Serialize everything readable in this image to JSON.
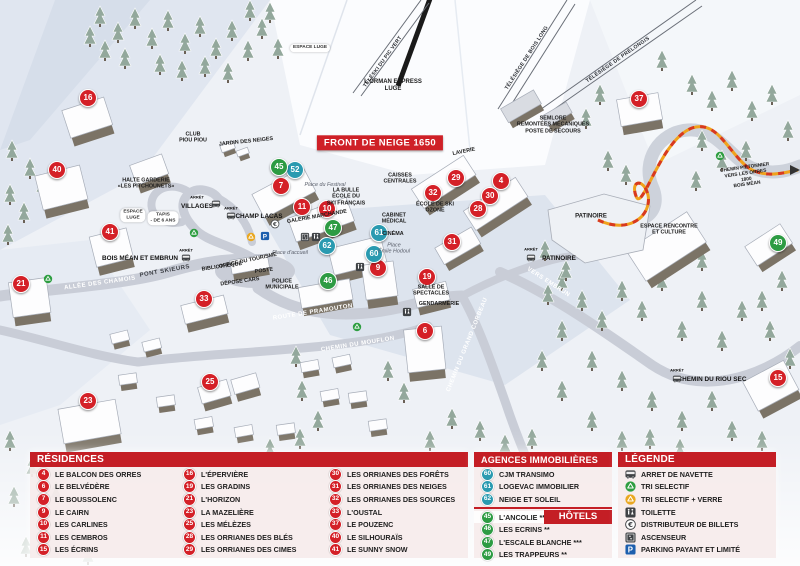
{
  "colors": {
    "header_red": "#c41e25",
    "marker_red": "#d42027",
    "marker_blue": "#2a9ab0",
    "marker_green": "#2d9b43",
    "path_orange": "#f0a21c",
    "path_red_dash": "#d8391f",
    "panel_pink": "#f6ecec"
  },
  "map": {
    "banner": "FRONT DE NEIGE 1650",
    "markers": [
      {
        "n": "16",
        "type": "red",
        "x": 88,
        "y": 98
      },
      {
        "n": "40",
        "type": "red",
        "x": 57,
        "y": 170
      },
      {
        "n": "41",
        "type": "red",
        "x": 110,
        "y": 232
      },
      {
        "n": "21",
        "type": "red",
        "x": 21,
        "y": 284
      },
      {
        "n": "33",
        "type": "red",
        "x": 204,
        "y": 299
      },
      {
        "n": "23",
        "type": "red",
        "x": 88,
        "y": 401
      },
      {
        "n": "25",
        "type": "red",
        "x": 210,
        "y": 382
      },
      {
        "n": "7",
        "type": "red",
        "x": 281,
        "y": 186
      },
      {
        "n": "11",
        "type": "red",
        "x": 302,
        "y": 207
      },
      {
        "n": "10",
        "type": "red",
        "x": 327,
        "y": 209
      },
      {
        "n": "9",
        "type": "red",
        "x": 378,
        "y": 268
      },
      {
        "n": "19",
        "type": "red",
        "x": 427,
        "y": 277
      },
      {
        "n": "6",
        "type": "red",
        "x": 425,
        "y": 331
      },
      {
        "n": "29",
        "type": "red",
        "x": 456,
        "y": 178
      },
      {
        "n": "4",
        "type": "red",
        "x": 501,
        "y": 181
      },
      {
        "n": "32",
        "type": "red",
        "x": 433,
        "y": 193
      },
      {
        "n": "30",
        "type": "red",
        "x": 490,
        "y": 196
      },
      {
        "n": "28",
        "type": "red",
        "x": 478,
        "y": 209
      },
      {
        "n": "31",
        "type": "red",
        "x": 452,
        "y": 242
      },
      {
        "n": "37",
        "type": "red",
        "x": 639,
        "y": 99
      },
      {
        "n": "15",
        "type": "red",
        "x": 778,
        "y": 378
      },
      {
        "n": "52",
        "type": "blue",
        "x": 295,
        "y": 170
      },
      {
        "n": "62",
        "type": "blue",
        "x": 327,
        "y": 246
      },
      {
        "n": "60",
        "type": "blue",
        "x": 374,
        "y": 254
      },
      {
        "n": "61",
        "type": "blue",
        "x": 379,
        "y": 233
      },
      {
        "n": "45",
        "type": "green",
        "x": 279,
        "y": 167
      },
      {
        "n": "47",
        "type": "green",
        "x": 333,
        "y": 228
      },
      {
        "n": "46",
        "type": "green",
        "x": 328,
        "y": 281
      },
      {
        "n": "49",
        "type": "green",
        "x": 778,
        "y": 243
      }
    ],
    "icons": [
      {
        "icon": "bus",
        "x": 216,
        "y": 204
      },
      {
        "icon": "bus",
        "x": 231,
        "y": 216
      },
      {
        "icon": "bus",
        "x": 186,
        "y": 258
      },
      {
        "icon": "bus",
        "x": 531,
        "y": 258
      },
      {
        "icon": "bus",
        "x": 677,
        "y": 379
      },
      {
        "icon": "recycle-green",
        "x": 48,
        "y": 279
      },
      {
        "icon": "recycle-green",
        "x": 194,
        "y": 233
      },
      {
        "icon": "recycle-green",
        "x": 357,
        "y": 327
      },
      {
        "icon": "recycle-green",
        "x": 720,
        "y": 156
      },
      {
        "icon": "recycle-yellow",
        "x": 251,
        "y": 237
      },
      {
        "icon": "parking",
        "x": 265,
        "y": 236
      },
      {
        "icon": "euro",
        "x": 275,
        "y": 224
      },
      {
        "icon": "elevator",
        "x": 305,
        "y": 237
      },
      {
        "icon": "toilet",
        "x": 316,
        "y": 237
      },
      {
        "icon": "toilet",
        "x": 360,
        "y": 267
      },
      {
        "icon": "toilet",
        "x": 407,
        "y": 312
      }
    ],
    "labels": [
      {
        "t": "TÉLÉSKI DU PIC VERT",
        "x": 383,
        "y": 62,
        "c": "lift",
        "r": -54
      },
      {
        "t": "L'ORMAN EXPRESS\nLUGE",
        "x": 393,
        "y": 86,
        "c": "place",
        "r": 0
      },
      {
        "t": "TÉLÉSIÈGE DE BOIS LONG",
        "x": 527,
        "y": 58,
        "c": "lift",
        "r": -57
      },
      {
        "t": "TÉLÉSIÈGE DE PRÉLONGIS",
        "x": 618,
        "y": 60,
        "c": "lift",
        "r": -35
      },
      {
        "t": "SEMLORE\nREMONTÉES MÉCANIQUES\nPOSTE DE SECOURS",
        "x": 553,
        "y": 125,
        "c": "place sm",
        "r": 0
      },
      {
        "t": "FRONT DE NEIGE 1650",
        "x": 380,
        "y": 143,
        "c": "banner",
        "r": 0
      },
      {
        "t": "CLUB\nPIOU PIOU",
        "x": 193,
        "y": 138,
        "c": "place sm",
        "r": 0
      },
      {
        "t": "JARDIN DES NEIGES",
        "x": 246,
        "y": 142,
        "c": "place sm",
        "r": -6
      },
      {
        "t": "ESPACE LUGE",
        "x": 310,
        "y": 48,
        "c": "pill",
        "r": 0
      },
      {
        "t": "HALTE GARDERIE\n«LES PITCHOUNETS»",
        "x": 146,
        "y": 184,
        "c": "place sm",
        "r": 0
      },
      {
        "t": "ESPACE\nLUGE",
        "x": 133,
        "y": 215,
        "c": "pill",
        "r": 0
      },
      {
        "t": "TAPIS\n- DE 6 ANS",
        "x": 163,
        "y": 218,
        "c": "pill",
        "r": 0
      },
      {
        "t": "ARRÊT",
        "x": 197,
        "y": 198,
        "c": "stop-sm",
        "r": 0
      },
      {
        "t": "VILLAGES",
        "x": 197,
        "y": 207,
        "c": "stop",
        "r": 0
      },
      {
        "t": "ARRÊT",
        "x": 231,
        "y": 209,
        "c": "stop-sm",
        "r": 0
      },
      {
        "t": "CHAMP LACAS",
        "x": 259,
        "y": 217,
        "c": "stop",
        "r": 0
      },
      {
        "t": "ARRÊT",
        "x": 186,
        "y": 251,
        "c": "stop-sm",
        "r": 0
      },
      {
        "t": "BOIS MÉAN ET EMBRUN",
        "x": 140,
        "y": 259,
        "c": "stop",
        "r": 0
      },
      {
        "t": "ARRÊT",
        "x": 531,
        "y": 250,
        "c": "stop-sm",
        "r": 0
      },
      {
        "t": "PATINOIRE",
        "x": 559,
        "y": 259,
        "c": "stop",
        "r": 0
      },
      {
        "t": "ARRÊT",
        "x": 677,
        "y": 371,
        "c": "stop-sm",
        "r": 0
      },
      {
        "t": "CHEMIN DU RIOU SEC",
        "x": 712,
        "y": 380,
        "c": "stop",
        "r": 0
      },
      {
        "t": "ALLÉE DES CHAMOIS",
        "x": 100,
        "y": 284,
        "c": "road",
        "r": -8
      },
      {
        "t": "PONT SKIEURS",
        "x": 165,
        "y": 272,
        "c": "road dk",
        "r": -10
      },
      {
        "t": "VERS EMBRUN",
        "x": 548,
        "y": 283,
        "c": "road",
        "r": 33
      },
      {
        "t": "ROUTE DE PRAMOUTON",
        "x": 313,
        "y": 313,
        "c": "road",
        "r": -9
      },
      {
        "t": "CHEMIN DU MOUFLON",
        "x": 358,
        "y": 345,
        "c": "road",
        "r": -9
      },
      {
        "t": "CHEMIN DU GRAND CORBEAU",
        "x": 468,
        "y": 345,
        "c": "road",
        "r": -68
      },
      {
        "t": "Place du Festival",
        "x": 325,
        "y": 185,
        "c": "pname",
        "r": 0
      },
      {
        "t": "Place d'accueil",
        "x": 290,
        "y": 253,
        "c": "pname",
        "r": 0
      },
      {
        "t": "Place\nÉmile Hodoul",
        "x": 394,
        "y": 249,
        "c": "pname",
        "r": 0
      },
      {
        "t": "LA BULLE\nÉCOLE DU\nSKI FRANÇAIS",
        "x": 346,
        "y": 197,
        "c": "place sm",
        "r": 0
      },
      {
        "t": "GALERIE MARCHANDE",
        "x": 317,
        "y": 217,
        "c": "place sm",
        "r": -10
      },
      {
        "t": "CAISSES\nCENTRALES",
        "x": 400,
        "y": 179,
        "c": "place sm",
        "r": 0
      },
      {
        "t": "LAVERIE",
        "x": 464,
        "y": 152,
        "c": "place sm",
        "r": -12
      },
      {
        "t": "ÉCOLE DE SKI\nOZONE",
        "x": 435,
        "y": 208,
        "c": "place sm",
        "r": 0
      },
      {
        "t": "CABINET\nMÉDICAL",
        "x": 394,
        "y": 219,
        "c": "place sm",
        "r": 0
      },
      {
        "t": "CINÉMA",
        "x": 393,
        "y": 234,
        "c": "place sm",
        "r": 0
      },
      {
        "t": "OFFICE DU TOURISME",
        "x": 248,
        "y": 261,
        "c": "place sm",
        "r": -12
      },
      {
        "t": "BIBLIOTHÈQUE",
        "x": 222,
        "y": 267,
        "c": "place sm",
        "r": -8
      },
      {
        "t": "POSTE",
        "x": 264,
        "y": 271,
        "c": "place sm",
        "r": -8
      },
      {
        "t": "DÉPOSE CARS",
        "x": 240,
        "y": 282,
        "c": "place sm",
        "r": -8
      },
      {
        "t": "POLICE\nMUNICIPALE",
        "x": 282,
        "y": 285,
        "c": "place sm",
        "r": 0
      },
      {
        "t": "SALLE DE\nSPECTACLES",
        "x": 431,
        "y": 291,
        "c": "place sm",
        "r": 0
      },
      {
        "t": "GENDARMERIE",
        "x": 439,
        "y": 304,
        "c": "place sm",
        "r": 0
      },
      {
        "t": "PATINOIRE",
        "x": 591,
        "y": 217,
        "c": "place",
        "r": 0
      },
      {
        "t": "ESPACE RENCONTRE\nET CULTURE",
        "x": 669,
        "y": 230,
        "c": "place sm",
        "r": 0
      },
      {
        "t": "CHEMIN PIÉTONNIER\nVERS LES ORRES 1800\nBOIS MÉAN",
        "x": 746,
        "y": 177,
        "c": "place xs",
        "r": -8
      }
    ]
  },
  "legend": {
    "residences": {
      "title": "RÉSIDENCES",
      "items": [
        {
          "num": "4",
          "name": "LE BALCON DES ORRES"
        },
        {
          "num": "6",
          "name": "LE BELVÉDÈRE"
        },
        {
          "num": "7",
          "name": "LE BOUSSOLENC"
        },
        {
          "num": "9",
          "name": "LE CAIRN"
        },
        {
          "num": "10",
          "name": "LES CARLINES"
        },
        {
          "num": "11",
          "name": "LES CEMBROS"
        },
        {
          "num": "15",
          "name": "LES ÉCRINS"
        },
        {
          "num": "16",
          "name": "L'ÉPERVIÈRE"
        },
        {
          "num": "19",
          "name": "LES GRADINS"
        },
        {
          "num": "21",
          "name": "L'HORIZON"
        },
        {
          "num": "23",
          "name": "LA MAZELIÈRE"
        },
        {
          "num": "25",
          "name": "LES MÉLÈZES"
        },
        {
          "num": "28",
          "name": "LES ORRIANES DES BLÉS"
        },
        {
          "num": "29",
          "name": "LES ORRIANES DES CIMES"
        },
        {
          "num": "30",
          "name": "LES ORRIANES DES FORÊTS"
        },
        {
          "num": "31",
          "name": "LES ORRIANES DES NEIGES"
        },
        {
          "num": "32",
          "name": "LES ORRIANES DES SOURCES"
        },
        {
          "num": "33",
          "name": "L'OUSTAL"
        },
        {
          "num": "37",
          "name": "LE POUZENC"
        },
        {
          "num": "40",
          "name": "LE SILHOURAÏS"
        },
        {
          "num": "41",
          "name": "LE SUNNY SNOW"
        }
      ]
    },
    "agences": {
      "title": "AGENCES IMMOBILIÈRES",
      "items": [
        {
          "num": "60",
          "name": "CJM TRANSIMO"
        },
        {
          "num": "61",
          "name": "LOGEVAC IMMOBILIER"
        },
        {
          "num": "62",
          "name": "NEIGE ET SOLEIL"
        }
      ]
    },
    "hotels": {
      "title": "HÔTELS",
      "items": [
        {
          "num": "45",
          "name": "L'ANCOLIE **"
        },
        {
          "num": "46",
          "name": "LES ECRINS **"
        },
        {
          "num": "47",
          "name": "L'ESCALE BLANCHE ***"
        },
        {
          "num": "49",
          "name": "LES TRAPPEURS **"
        }
      ]
    },
    "legende": {
      "title": "LÉGENDE",
      "items": [
        {
          "icon": "bus",
          "label": "ARRET DE NAVETTE"
        },
        {
          "icon": "recycle-green",
          "label": "TRI SELECTIF"
        },
        {
          "icon": "recycle-yellow",
          "label": "TRI SELECTIF + VERRE"
        },
        {
          "icon": "toilet",
          "label": "TOILETTE"
        },
        {
          "icon": "euro",
          "label": "DISTRIBUTEUR DE BILLETS"
        },
        {
          "icon": "elevator",
          "label": "ASCENSEUR"
        },
        {
          "icon": "parking",
          "label": "PARKING PAYANT ET LIMITÉ"
        }
      ]
    }
  }
}
